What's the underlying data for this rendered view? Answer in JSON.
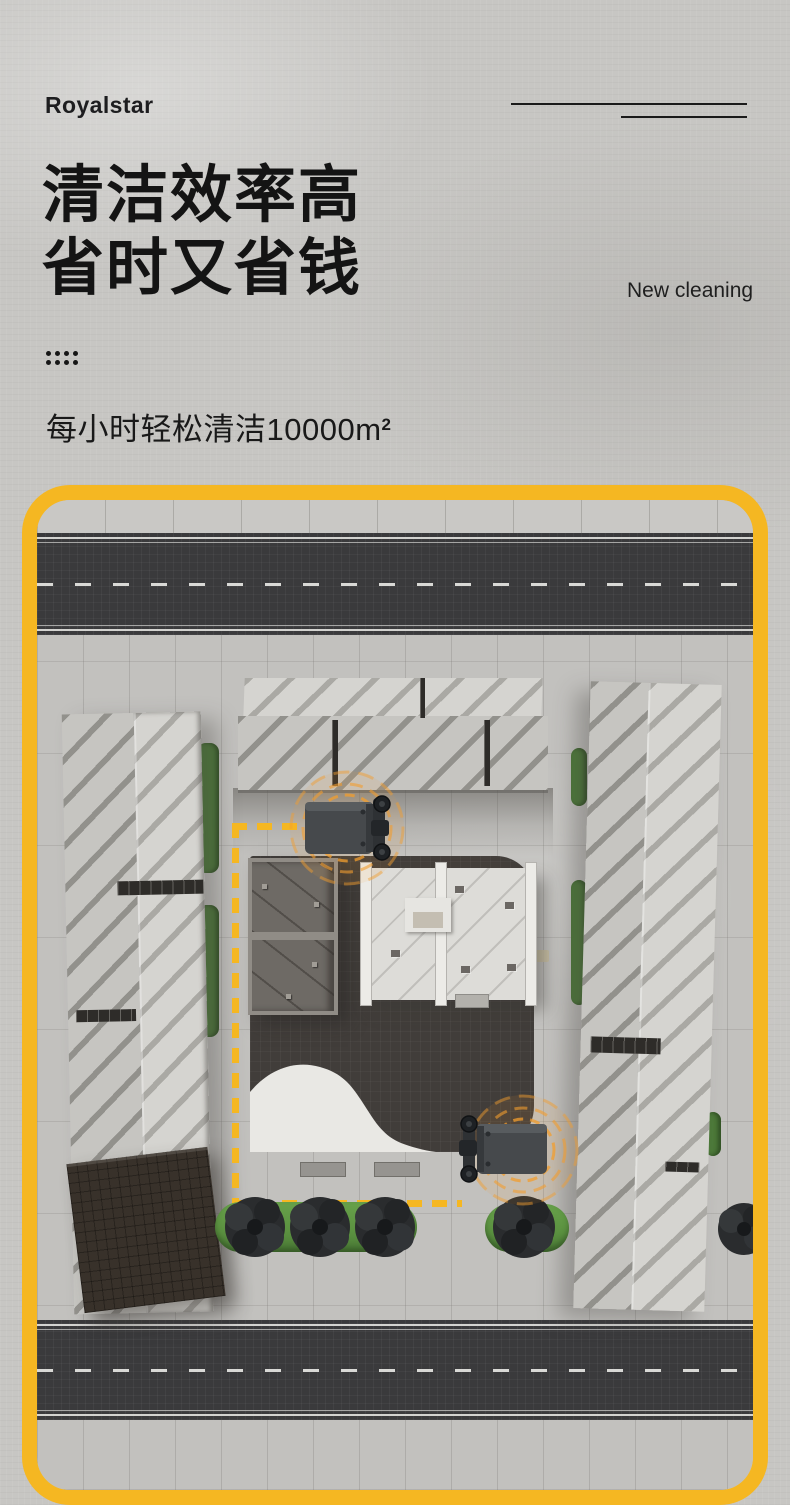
{
  "brand": {
    "logo_text": "Royalstar"
  },
  "header": {
    "title_line1": "清洁效率高",
    "title_line2": "省时又省钱",
    "tagline": "New cleaning",
    "subtitle_text": "每小时轻松清洁10000m",
    "subtitle_sup": "2"
  },
  "colors": {
    "accent-yellow": "#F5B722",
    "signal-orange": "#F29D2E",
    "hedge-green": "#5B9140",
    "hedge-dark-green": "#4D7A3A",
    "road-dark": "#3A3A3C",
    "plaza-brown": "#413D3A",
    "ink": "#161616"
  }
}
